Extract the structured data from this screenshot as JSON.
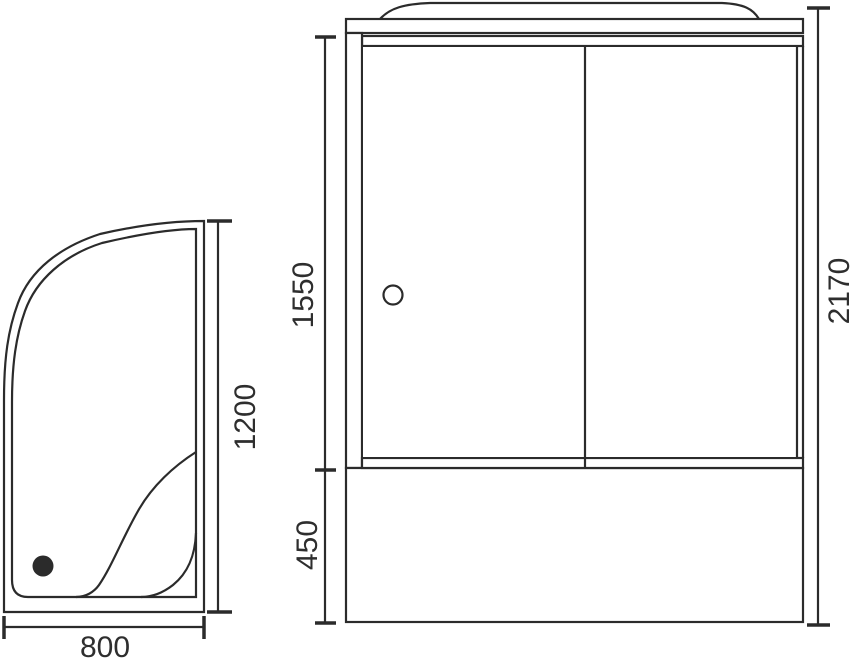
{
  "drawing": {
    "type": "shower-cabin-technical-drawing",
    "views": {
      "tray_top_view": {
        "description_labels": [],
        "width_label": "800",
        "depth_label": "1200"
      },
      "cabin_front_view": {
        "door_height_label": "1550",
        "base_height_label": "450",
        "total_height_label": "2170"
      }
    },
    "colors": {
      "line": "#2b2b2b",
      "text": "#2e2e2e",
      "background": "#ffffff"
    }
  }
}
